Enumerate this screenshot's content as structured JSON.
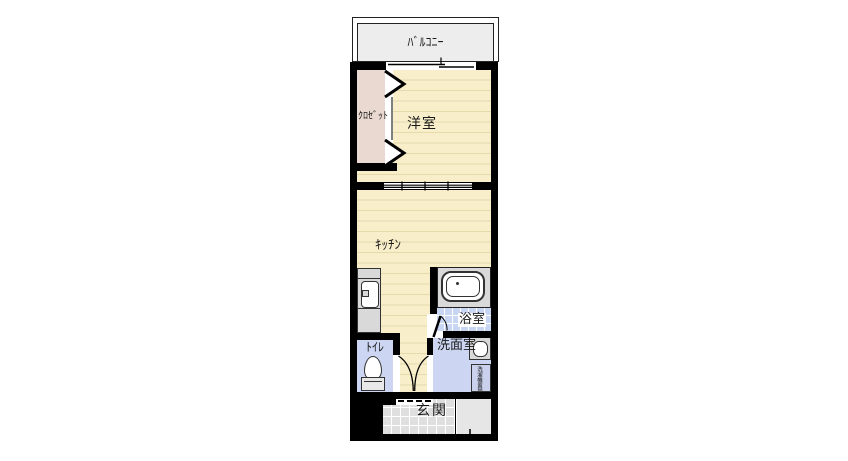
{
  "floorplan": {
    "rooms": {
      "balcony": {
        "label": "ﾊﾞﾙｺﾆｰ"
      },
      "bedroom": {
        "label": "洋室"
      },
      "closet": {
        "label": "ｸﾛｾﾞｯﾄ"
      },
      "kitchen": {
        "label": "ｷｯﾁﾝ"
      },
      "bathroom": {
        "label": "浴室"
      },
      "washroom": {
        "label": "洗面室"
      },
      "toilet": {
        "label": "ﾄｲﾚ"
      },
      "entrance": {
        "label": "玄関"
      }
    },
    "fixtures": {
      "washer_area_label": "洗濯機置場"
    },
    "colors": {
      "wall": "#000000",
      "flooring": "#f8eeca",
      "flooring-line": "#e4daac",
      "closet-fill": "#e9d9d1",
      "wet-area-fill": "#ccd5f1",
      "tile-bath": "#c9d6f3",
      "genkan-tile": "#dfdfdf",
      "porch-fill": "#e6e6e6",
      "balcony-fill": "#ededed",
      "fixture-gray": "#d9d9d9",
      "text": "#1a1a1a"
    }
  }
}
